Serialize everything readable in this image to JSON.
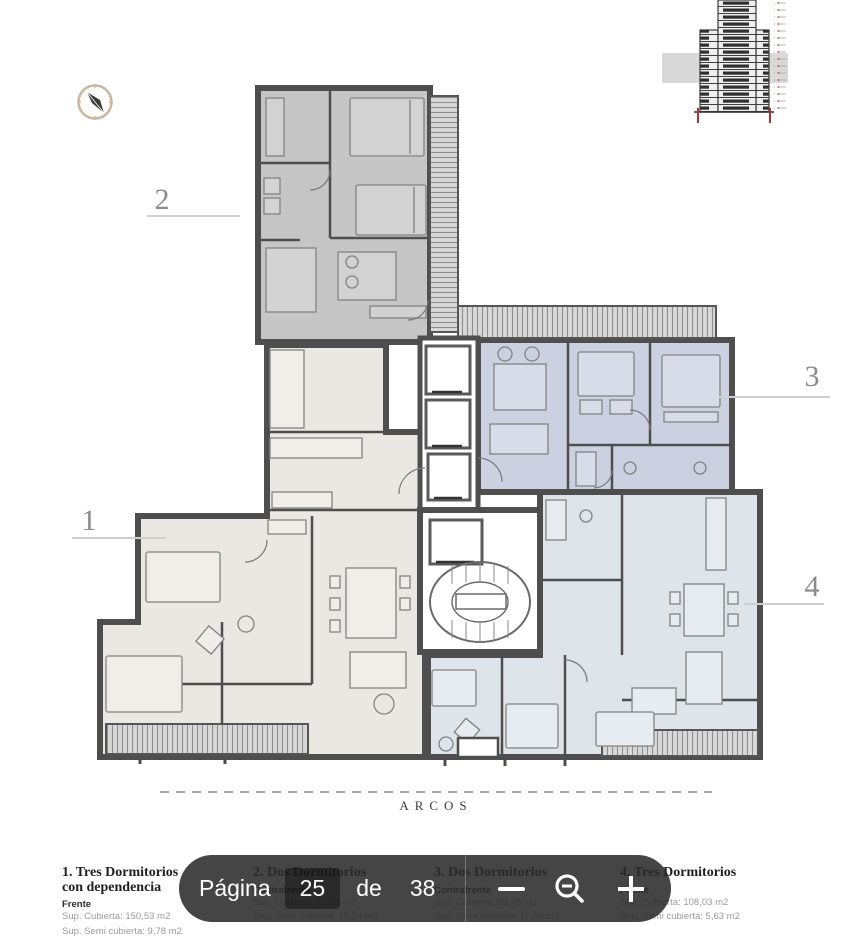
{
  "viewer_toolbar": {
    "page_word": "Página",
    "current_page": "25",
    "of_word": "de",
    "total_pages": "38",
    "icons": {
      "minus": "minus-icon",
      "zoom_out": "zoom-out-icon",
      "plus": "plus-icon"
    },
    "bg_color": "rgba(43,43,43,0.88)"
  },
  "plan": {
    "street_label": "ARCOS",
    "unit_labels": {
      "u1": "1",
      "u2": "2",
      "u3": "3",
      "u4": "4"
    },
    "colors": {
      "walls": "#4e4e4e",
      "unit1_fill": "#e9e8e2",
      "unit2_fill": "#c6c6c6",
      "unit3_fill": "#cbd1e0",
      "unit4_fill": "#dde4ea",
      "hatch": "#8f8f8f",
      "compass_ring": "#cbb8a2",
      "elevation_red": "#b03030"
    }
  },
  "legend": {
    "items": [
      {
        "title": "1. Tres Dormitorios",
        "subtitle": "con dependencia",
        "orientation": "Frente",
        "line1": "Sup. Cubierta: 150,53 m2",
        "line2": "Sup. Semi cubierta: 9,78 m2"
      },
      {
        "title": "2. Dos Dormitorios",
        "subtitle": "",
        "orientation": "Contrafrente",
        "line1": "Sup. Cubierta: 76,83 m2",
        "line2": "Sup. Semi cubierta: 15,54 m2"
      },
      {
        "title": "3. Dos Dormitorios",
        "subtitle": "",
        "orientation": "Contrafrente",
        "line1": "Sup. Cubierta: 69,48 m2",
        "line2": "Sup. Semi cubierta: 17,08 m2"
      },
      {
        "title": "4. Tres Dormitorios",
        "subtitle": "",
        "orientation": "Frente",
        "line1": "Sup. Cubierta: 108,03 m2",
        "line2": "Sup. Semi cubierta: 5,63 m2"
      }
    ]
  }
}
